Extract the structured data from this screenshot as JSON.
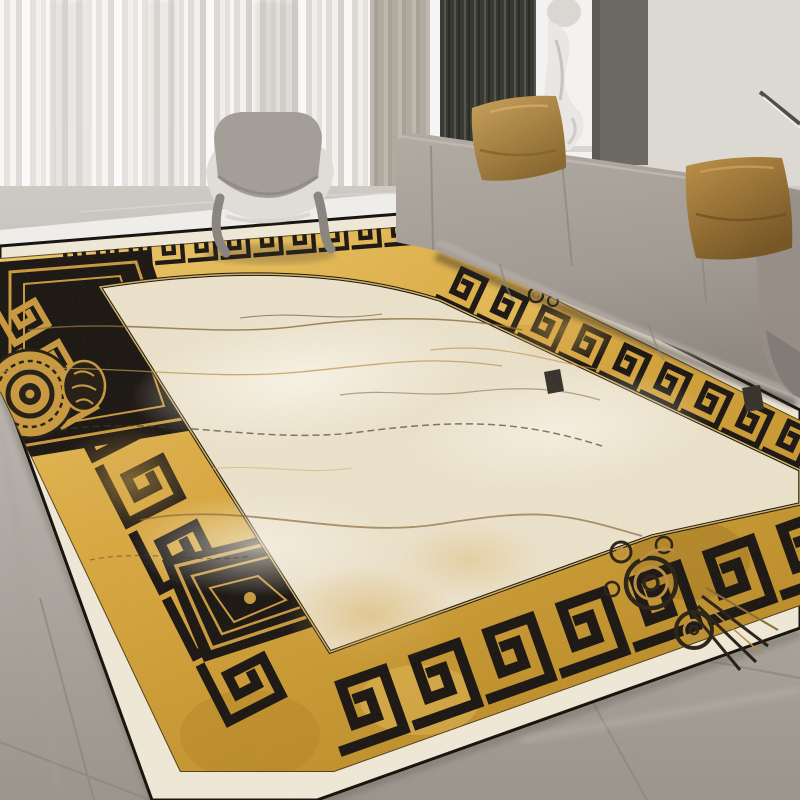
{
  "scene": {
    "type": "photograph",
    "label": "Modern living room with luxury greek-key marble rug",
    "room": "living room interior"
  },
  "objects": {
    "curtains": {
      "label": "white sheer curtains"
    },
    "curtain_panel": {
      "label": "beige curtain panel"
    },
    "window_frame": {
      "label": "white window frame strip"
    },
    "slat_panel": {
      "label": "dark wood slat wall panel"
    },
    "sculpture": {
      "label": "white abstract sculpture on pedestal"
    },
    "wall_panel": {
      "label": "dark grey wall panel"
    },
    "wall": {
      "label": "light grey wall"
    },
    "picture_frame": {
      "label": "leaning picture frame corner"
    },
    "sofa": {
      "label": "grey three-seat fabric sofa"
    },
    "pillow_left": {
      "label": "mustard gold throw pillow"
    },
    "pillow_right": {
      "label": "mustard gold throw pillow"
    },
    "lounge_chair": {
      "label": "grey sculptural lounge chair"
    },
    "floor": {
      "label": "grey marble tile floor"
    },
    "rug": {
      "label": "gold and black greek key border rug with cream marble field",
      "border_style": "greek key meander, black on gold",
      "field_style": "cream marble with gold and umber veins",
      "corner_medallion": "black square medallion with gold meander spiral",
      "rosette_medallion": "round gold rosette medallion on black block",
      "spiral_ornament": "gold spiral crest ornament near bottom-right corner"
    }
  },
  "palette": {
    "wall": "#d8d4ce",
    "wall-dark-panel": "#6d6a63",
    "slat-dark": "#3a3a34",
    "slat-light": "#55544d",
    "curtain-light": "#f4f3f0",
    "curtain-shadow": "#cecbc5",
    "curtain-tan": "#b5afa4",
    "floor-light": "#efede9",
    "floor-gray": "#b4afa9",
    "floor-gray-deep": "#9d9890",
    "floor-grout": "#8b867f",
    "sofa-base": "#a49d95",
    "sofa-high": "#b7b0a8",
    "sofa-shadow": "#847d75",
    "pillow-gold": "#bb9350",
    "pillow-gold-dark": "#7f5f2b",
    "chair-fabric": "#a39e97",
    "chair-shell": "#e0ddd8",
    "chair-leg": "#8a857e",
    "rug-margin": "#f0e9d7",
    "rug-field": "#ece2cb",
    "rug-field-light": "#f8f3e5",
    "gold": "#d9a83f",
    "gold-light": "#eec869",
    "gold-deep": "#a87c1f",
    "black-pattern": "#1a1511",
    "vein-gold": "#b98f49",
    "vein-dark": "#4a3c28",
    "edge-dark": "#17120d",
    "shadow": "#3a332b"
  }
}
